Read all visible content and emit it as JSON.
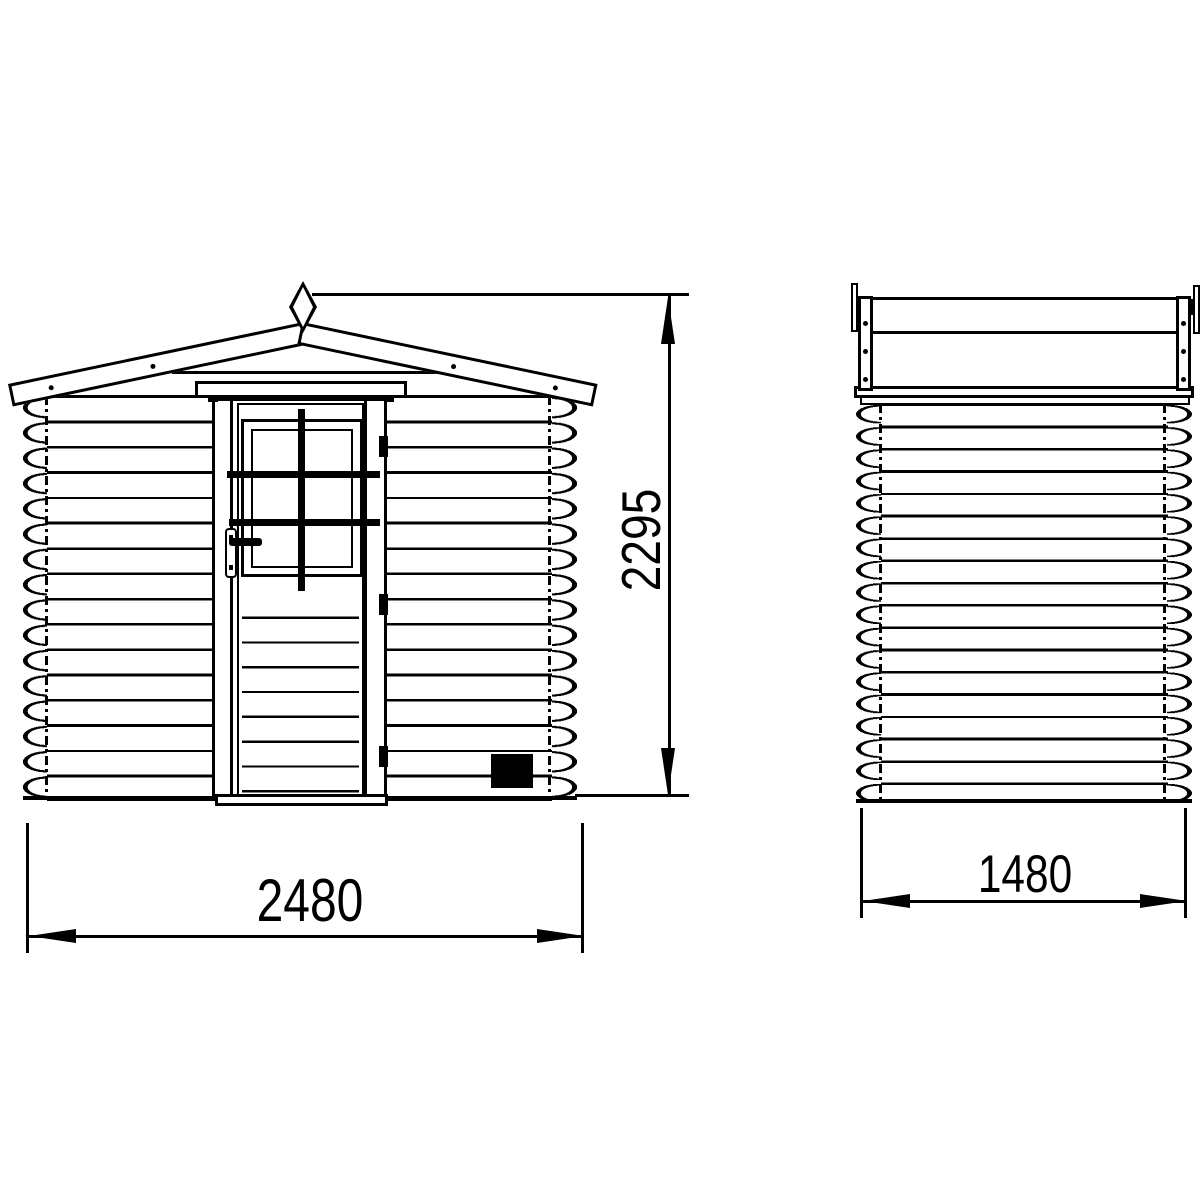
{
  "dimensions": {
    "front_width": "2480",
    "front_height": "2295",
    "side_depth": "1480"
  },
  "colors": {
    "line": "#000000",
    "background": "#ffffff"
  }
}
